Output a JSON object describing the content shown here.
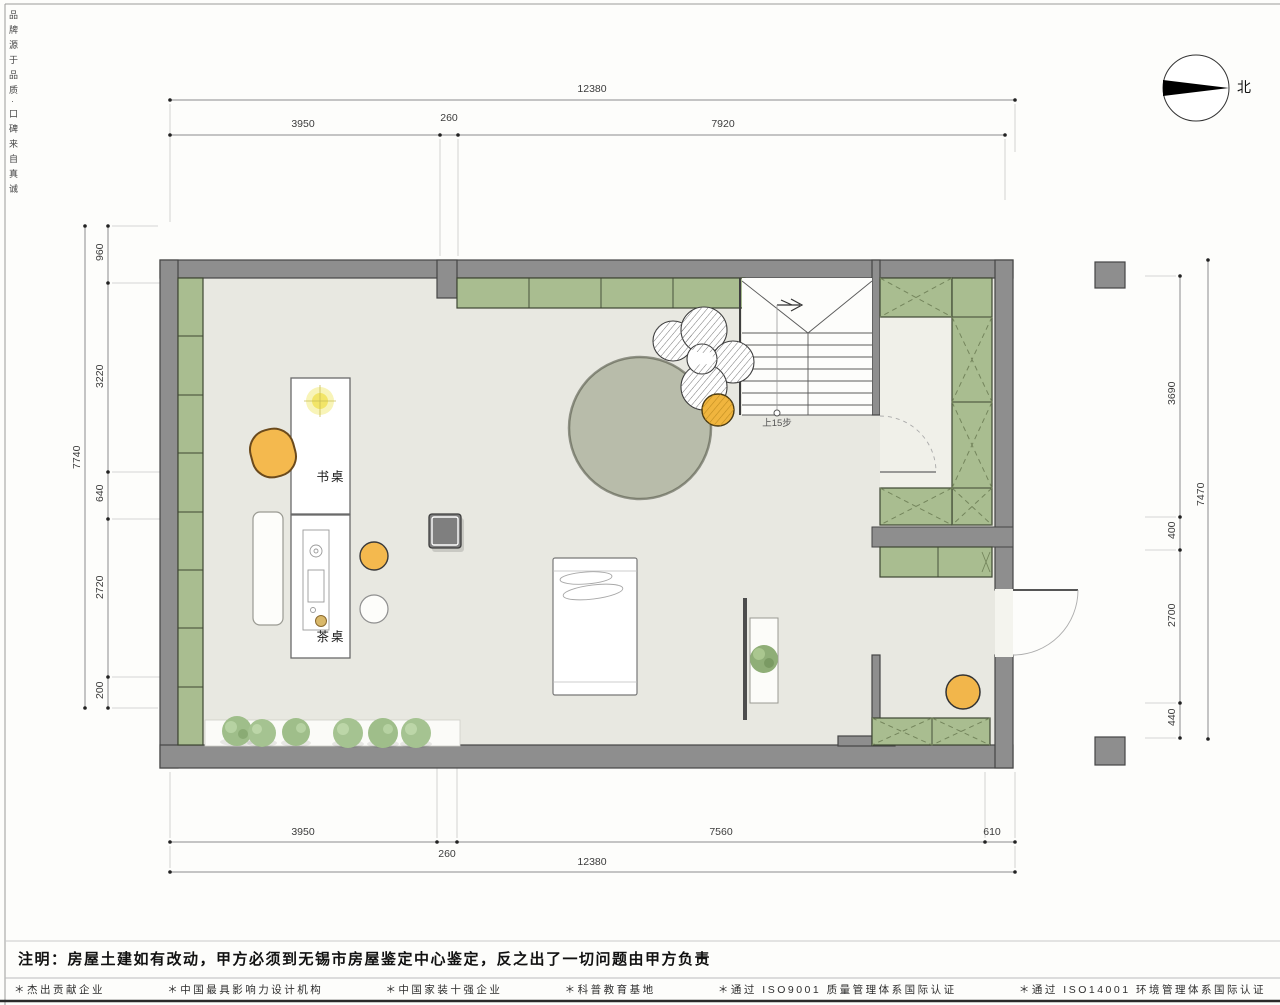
{
  "frame": {
    "side_text": "品牌源于品质·口碑来自真诚"
  },
  "compass": {
    "north_label": "北"
  },
  "plan_labels": {
    "desk": "书桌",
    "tea_table": "茶桌",
    "stairs_note": "上15步"
  },
  "dimensions": {
    "top": {
      "overall": "12380",
      "segments": [
        "3950",
        "260",
        "7920"
      ]
    },
    "bottom": {
      "overall": "12380",
      "segments": [
        "3950",
        "260",
        "7560",
        "610"
      ]
    },
    "left": {
      "overall": "7740",
      "segments": [
        "960",
        "3220",
        "640",
        "2720",
        "200"
      ]
    },
    "right": {
      "overall": "7470",
      "segments": [
        "3690",
        "400",
        "2700",
        "440"
      ]
    }
  },
  "notes": {
    "disclaimer": "注明：房屋土建如有改动，甲方必须到无锡市房屋鉴定中心鉴定，反之出了一切问题由甲方负责"
  },
  "footer": {
    "items": [
      "＊杰出贡献企业",
      "＊中国最具影响力设计机构",
      "＊中国家装十强企业",
      "＊科普教育基地",
      "＊通过 ISO9001 质量管理体系国际认证",
      "＊通过 ISO14001 环境管理体系国际认证"
    ]
  },
  "colors": {
    "wall": "#8e8e8e",
    "cabinet_green": "#a9bd90",
    "floor": "#e8e8e1",
    "rug": "#b8bcaa",
    "accent_orange": "#f2b64b"
  }
}
